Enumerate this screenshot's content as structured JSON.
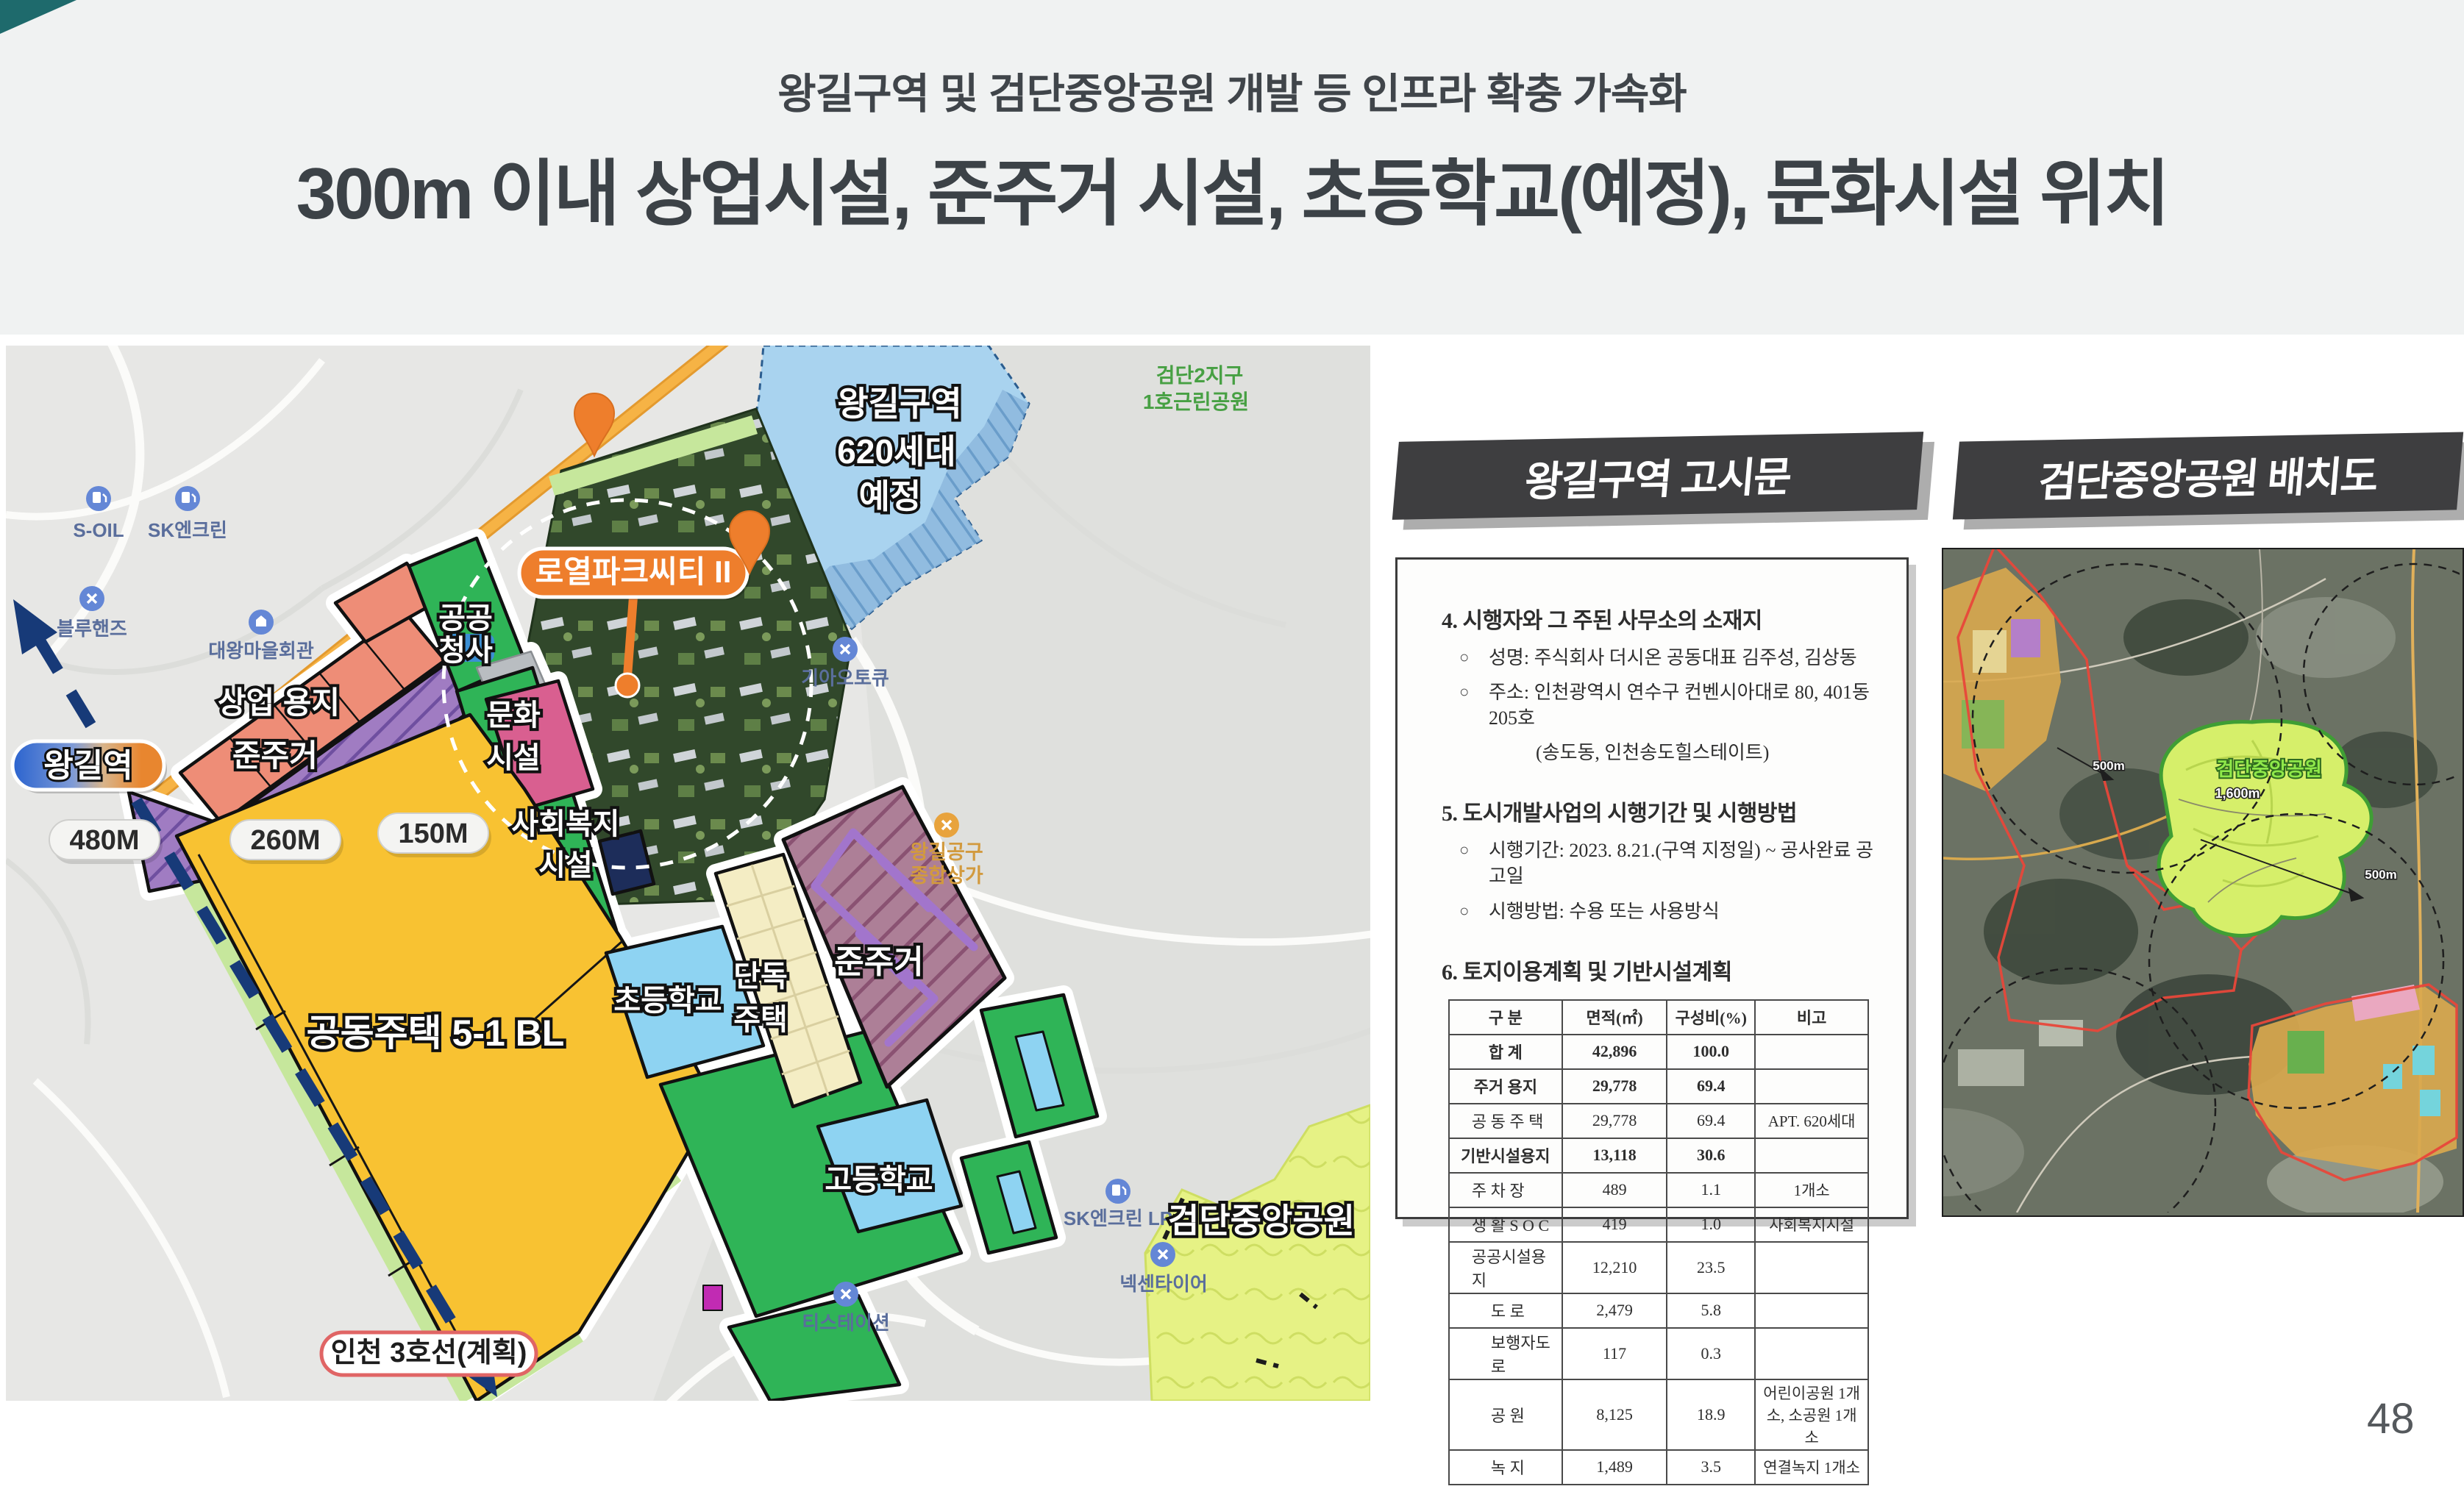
{
  "slide": {
    "title_line1": "왕길구역 및 검단중앙공원 개발 등 인프라 확충 가속화",
    "title_line2": "300m 이내 상업시설, 준주거 시설, 초등학교(예정), 문화시설 위치",
    "page_number": "48"
  },
  "map": {
    "station_badge": "왕길역",
    "distance": {
      "d480": "480M",
      "d260": "260M",
      "d150": "150M"
    },
    "project_badge": "로열파크씨티 II",
    "planned_zone": {
      "line1": "왕길구역",
      "line2": "620세대",
      "line3": "예정"
    },
    "zones": {
      "commercial": "상업 용지",
      "semi_res_small": "준주거",
      "public1": "공공",
      "public2": "청사",
      "culture1": "문화",
      "culture2": "시설",
      "welfare1": "사회복지",
      "welfare2": "시설",
      "apartment": "공동주택 5-1 BL",
      "elementary": "초등학교",
      "detached1": "단독",
      "detached2": "주택",
      "semi_res_large": "준주거",
      "high_school": "고등학교"
    },
    "subway_label": "인천 3호선(계획)",
    "park_label": "검단중앙공원",
    "poi": {
      "soil": "S-OIL",
      "sk": "SK엔크린",
      "bluehands": "블루핸즈",
      "daewang": "대왕마을회관",
      "kia": "기아오토큐",
      "tools1": "왕길공구",
      "tools2": "종합상가",
      "sklp": "SK엔크린 LP",
      "nexen": "넥센타이어",
      "tstation": "티스테이션",
      "gd1": "검단2지구",
      "gd2": "1호근린공원"
    }
  },
  "notice_panel": {
    "banner": "왕길구역 고시문",
    "sections": [
      {
        "no": "4.",
        "title": "시행자와 그 주된 사무소의 소재지",
        "items": [
          "성명: 주식회사 더시온 공동대표 김주성, 김상동",
          "주소: 인천광역시 연수구 컨벤시아대로 80, 401동205호",
          "(송도동, 인천송도힐스테이트)"
        ]
      },
      {
        "no": "5.",
        "title": "도시개발사업의 시행기간 및 시행방법",
        "items": [
          "시행기간: 2023. 8.21.(구역 지정일) ~ 공사완료 공고일",
          "시행방법: 수용 또는 사용방식"
        ]
      },
      {
        "no": "6.",
        "title": "토지이용계획 및 기반시설계획",
        "items": []
      }
    ],
    "table": {
      "headers": [
        "구  분",
        "면적(㎡)",
        "구성비(%)",
        "비고"
      ],
      "rows": [
        {
          "name": "합  계",
          "area": "42,896",
          "ratio": "100.0",
          "note": "",
          "level": 0,
          "bold": true
        },
        {
          "name": "주거 용지",
          "area": "29,778",
          "ratio": "69.4",
          "note": "",
          "level": 0,
          "bold": true
        },
        {
          "name": "공 동 주 택",
          "area": "29,778",
          "ratio": "69.4",
          "note": "APT. 620세대",
          "level": 1,
          "bold": false
        },
        {
          "name": "기반시설용지",
          "area": "13,118",
          "ratio": "30.6",
          "note": "",
          "level": 0,
          "bold": true
        },
        {
          "name": "주  차  장",
          "area": "489",
          "ratio": "1.1",
          "note": "1개소",
          "level": 1,
          "bold": false
        },
        {
          "name": "생 활 S O C",
          "area": "419",
          "ratio": "1.0",
          "note": "사회복지시설",
          "level": 1,
          "bold": false
        },
        {
          "name": "공공시설용지",
          "area": "12,210",
          "ratio": "23.5",
          "note": "",
          "level": 1,
          "bold": false
        },
        {
          "name": "도  로",
          "area": "2,479",
          "ratio": "5.8",
          "note": "",
          "level": 2,
          "bold": false
        },
        {
          "name": "보행자도로",
          "area": "117",
          "ratio": "0.3",
          "note": "",
          "level": 2,
          "bold": false
        },
        {
          "name": "공  원",
          "area": "8,125",
          "ratio": "18.9",
          "note": "어린이공원 1개소, 소공원 1개소",
          "level": 2,
          "bold": false
        },
        {
          "name": "녹  지",
          "area": "1,489",
          "ratio": "3.5",
          "note": "연결녹지 1개소",
          "level": 2,
          "bold": false
        }
      ]
    }
  },
  "layout_panel": {
    "banner": "검단중앙공원 배치도",
    "map_label": "검단중앙공원",
    "d1": "500m",
    "d2": "1,600m",
    "d3": "500m"
  }
}
